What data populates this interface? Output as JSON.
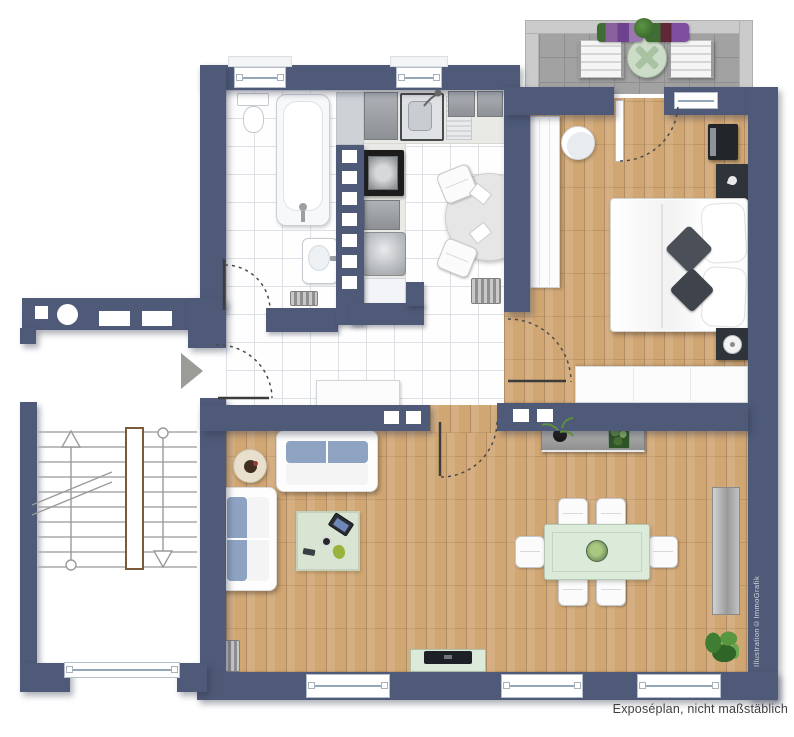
{
  "texts": {
    "caption": "Exposéplan, nicht maßstäblich",
    "watermark": "Illustration©ImmoGrafik"
  },
  "palette": {
    "wall": "#4e5a78",
    "wood": "#d0a673",
    "wood-seam": "#b4854f",
    "tile-bg": "#fefefe",
    "tile-line": "#dde1e6",
    "balcony-floor": "#a2a2a2",
    "balcony-rail": "#cbcbcb",
    "cushion": "#8ea3c2",
    "rug": "#d9e4d3",
    "glass-green": "#dcead9",
    "dark-furniture": "#2f333a",
    "metal": "#b7babd",
    "arrow": "#9b9b98",
    "caption-color": "#3f3f3f",
    "watermark-color": "#e8e8ec",
    "door-line": "#3c3c3c"
  }
}
